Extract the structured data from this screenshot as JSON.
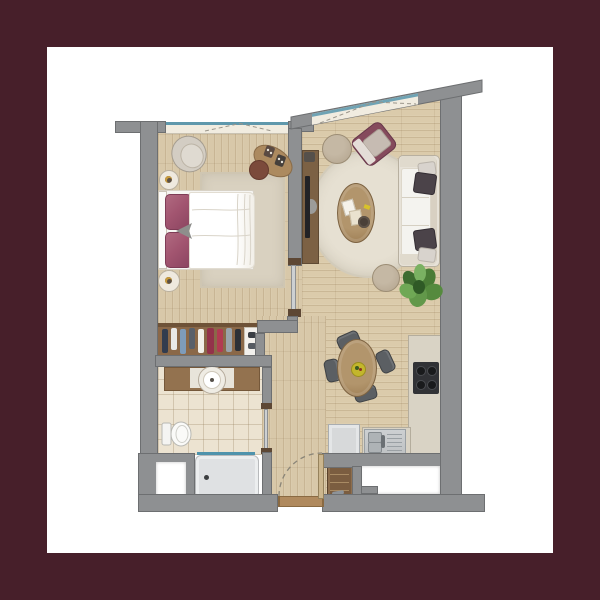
{
  "scene": {
    "type": "architectural floor plan render",
    "view": "top-down 2D color floor plan of a one-bedroom apartment",
    "visible_text": "none",
    "frame_border_color": "#471f2a",
    "page_background": "#ffffff"
  },
  "palette": {
    "wall_gray": "#8e9092",
    "wall_outline": "#6d6f71",
    "wood_floor": "#d8c8a9",
    "bath_tile": "#ece3d1",
    "rug_beige": "#d9d1c0",
    "window_glass_teal": "#5f98ac",
    "window_sill_cream": "#f1ece0",
    "bed_pillow_maroon": "#a25570",
    "accent_armchair_maroon": "#854a5c",
    "sofa_cream": "#e7e2d8",
    "furniture_wood": "#a8885e",
    "kitchen_counter": "#d9d3c5",
    "cooktop_black": "#313236",
    "steel_sink": "#c4c7c9",
    "plant_green": "#4f8438",
    "door_wood": "#b08a5e"
  },
  "rooms": {
    "bedroom": {
      "window": "top wall casement with dashed opening symbol",
      "furniture": [
        "double-bed with maroon pillows and white duvet",
        "headboard",
        "nightstand x2",
        "cream armchair",
        "dressing-desk",
        "round stool",
        "area rug",
        "open wardrobe with hanging clothes"
      ]
    },
    "living_dining": {
      "window": "slanted top wall casement with dashed opening symbol",
      "furniture": [
        "three-seat cream sofa with dark cushions",
        "maroon accent armchair",
        "pouf x2",
        "round cream rug",
        "oval wood coffee table with books and tray",
        "tv unit with tv",
        "oval dining table with fruit bowl",
        "dining chair x4",
        "potted plant"
      ]
    },
    "kitchen": {
      "furniture": [
        "L-shaped counter",
        "4-burner cooktop",
        "stainless double sink with drainboard",
        "appliance cabinet",
        "shoe cabinet with shelves"
      ]
    },
    "bathroom": {
      "furniture": [
        "vanity counter with round basin",
        "toilet",
        "shower tray with glass screen",
        "sliding door"
      ]
    },
    "entrance": {
      "features": [
        "entry door with dashed swing arc",
        "wood threshold",
        "exterior niche x2",
        "structural pillar"
      ]
    }
  }
}
